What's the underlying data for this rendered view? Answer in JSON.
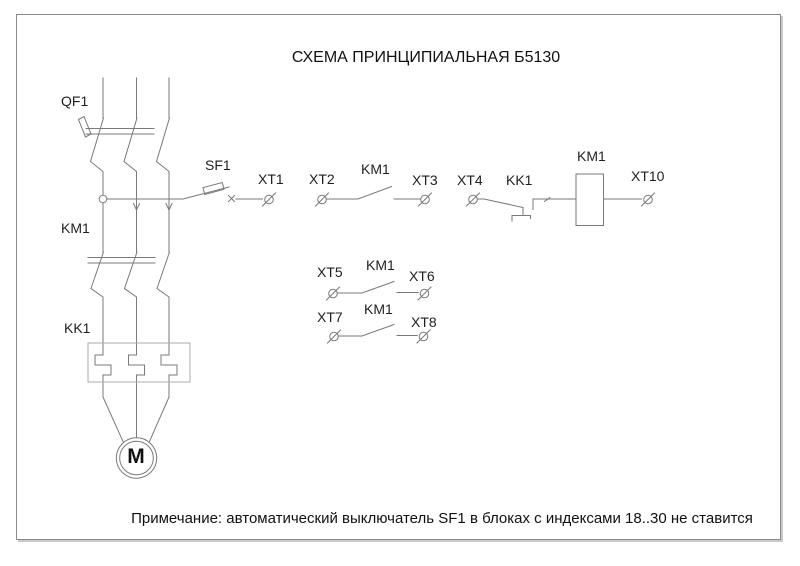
{
  "title": "СХЕМА ПРИНЦИПИАЛЬНАЯ Б5130",
  "note": "Примечание: автоматический выключатель SF1 в блоках с индексами 18..30 не ставится",
  "labels": {
    "qf1": "QF1",
    "km1_main": "KM1",
    "kk1_main": "KK1",
    "sf1": "SF1",
    "xt1": "XT1",
    "xt2": "XT2",
    "km1_contact1": "KM1",
    "xt3": "XT3",
    "xt4": "XT4",
    "kk1_contact": "KK1",
    "km1_coil": "KM1",
    "xt10": "XT10",
    "xt5": "XT5",
    "km1_contact2": "KM1",
    "xt6": "XT6",
    "xt7": "XT7",
    "km1_contact3": "KM1",
    "xt8": "XT8",
    "motor": "M"
  },
  "colors": {
    "line": "#7a7a7a",
    "thermal_box": "#ababab",
    "frame": "#8a8a8a",
    "text": "#1f1f1f",
    "background": "#ffffff"
  }
}
